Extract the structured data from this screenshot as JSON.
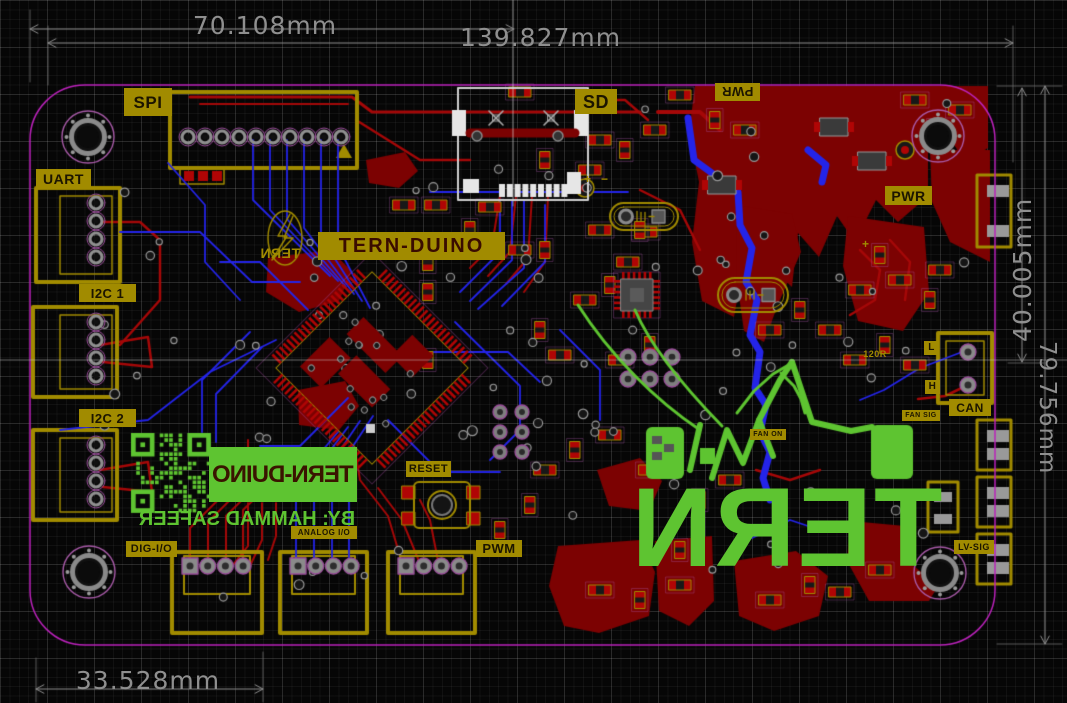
{
  "board": {
    "silkscreen": {
      "spi": "SPI",
      "uart": "UART",
      "i2c_1": "I2C 1",
      "i2c_2": "I2C 2",
      "dig_io": "DIG-I/O",
      "analog_io": "ANALOG I/O",
      "pwm": "PWM",
      "reset": "RESET",
      "sd": "SD",
      "pwr_top": "PWR",
      "pwr_right": "PWR",
      "can": "CAN",
      "can_l": "L",
      "can_h": "H",
      "fan_sig": "FAN SIG",
      "fan_on": "FAN ON",
      "lv_sig": "LV-SIG",
      "resistor_120": "120R",
      "tern_duino": "TERN-DUINO",
      "tern_bird": "TERN",
      "plus": "+",
      "minus": "−"
    },
    "artwork": {
      "sticker": "TERN-DUINO",
      "credit": "BY:   HAMMAD SAFEER",
      "logo": "TERN",
      "qr": "qr-code-icon"
    },
    "dimensions": {
      "d_70": "70.108mm",
      "d_139": "139.827mm",
      "d_40": "40.005mm",
      "d_79": "79.756mm",
      "d_33": "33.528mm"
    },
    "colors": {
      "pour": "#7c0202",
      "pad": "#b00505",
      "trace_red": "#a50808",
      "blue": "#2424e8",
      "gold": "#a18b00",
      "outline": "#bb22bb",
      "green": "#5ec431",
      "dim": "#8f8f8f",
      "white": "#dddddd"
    }
  }
}
